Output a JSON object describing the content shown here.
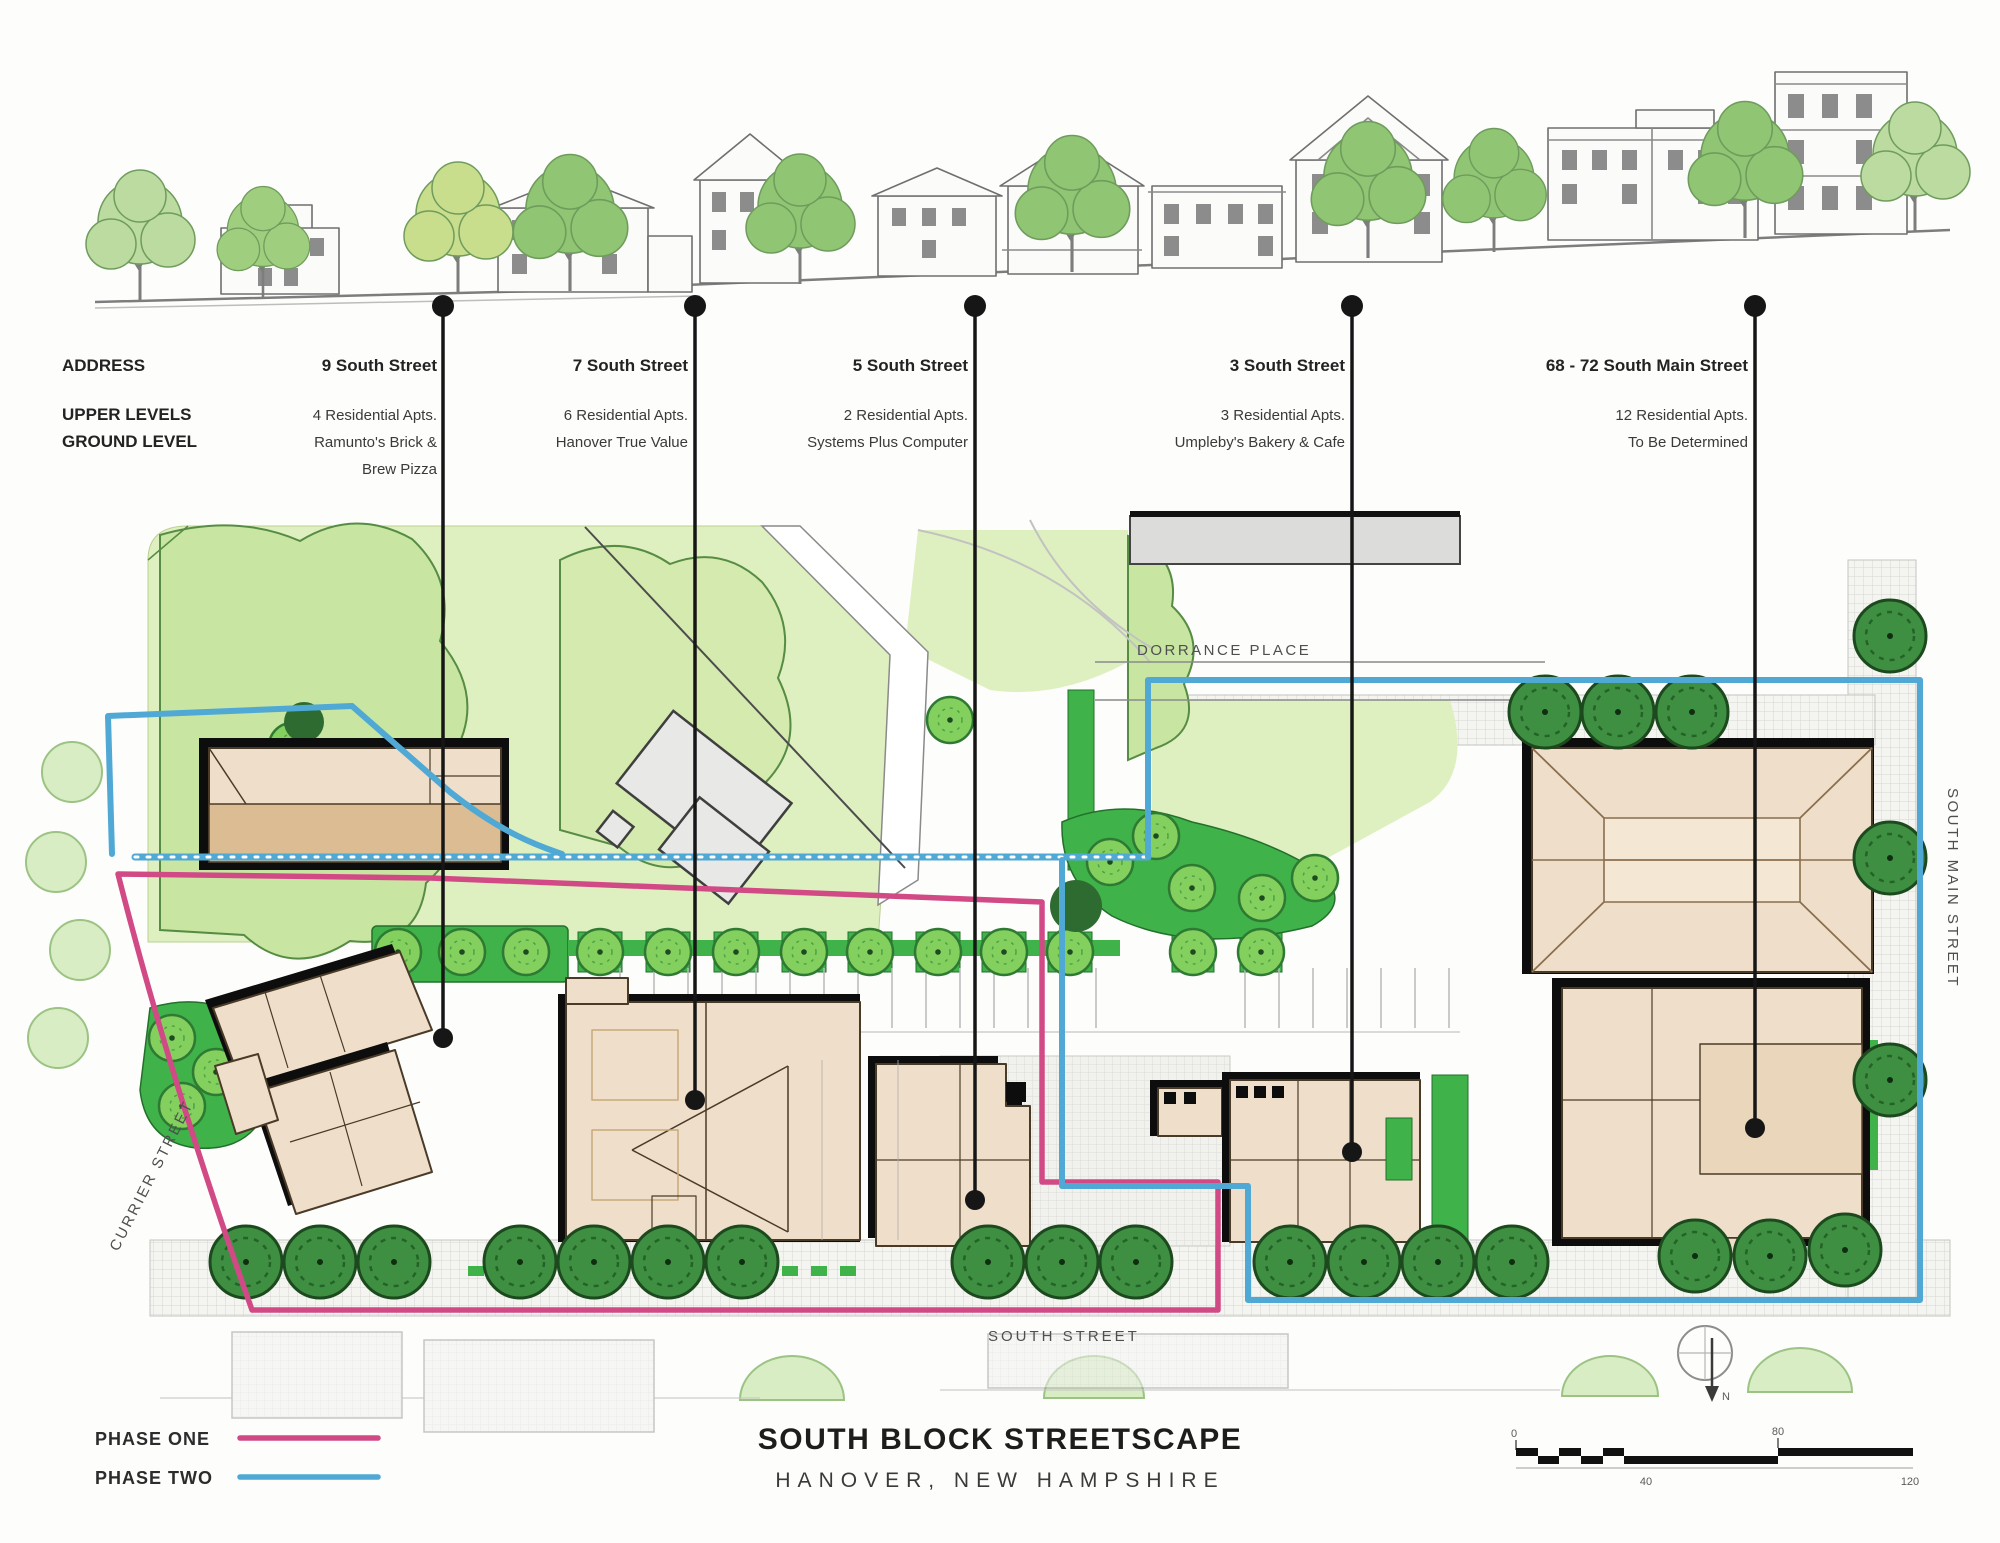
{
  "title": {
    "line1": "SOUTH BLOCK STREETSCAPE",
    "line2": "HANOVER, NEW HAMPSHIRE"
  },
  "row_labels": {
    "address": "ADDRESS",
    "upper": "UPPER LEVELS",
    "ground": "GROUND LEVEL"
  },
  "columns": [
    {
      "address": "9 South Street",
      "lines": [
        "4 Residential Apts.",
        "Ramunto's Brick &",
        "Brew Pizza"
      ]
    },
    {
      "address": "7 South Street",
      "lines": [
        "6 Residential Apts.",
        "Hanover True Value"
      ]
    },
    {
      "address": "5 South Street",
      "lines": [
        "2 Residential Apts.",
        "Systems Plus Computer"
      ]
    },
    {
      "address": "3 South Street",
      "lines": [
        "3 Residential Apts.",
        "Umpleby's Bakery & Cafe"
      ]
    },
    {
      "address": "68 - 72  South Main Street",
      "lines": [
        "12 Residential Apts.",
        "To Be Determined"
      ]
    }
  ],
  "streets": {
    "dorrance": "DORRANCE PLACE",
    "south_main": "SOUTH MAIN STREET",
    "currier": "CURRIER STREET",
    "south": "SOUTH STREET"
  },
  "legend": [
    {
      "label": "PHASE ONE",
      "color": "#D14A86"
    },
    {
      "label": "PHASE TWO",
      "color": "#4FA9D4"
    }
  ],
  "scale_bar": {
    "labels": [
      "0",
      "40",
      "80",
      "120"
    ]
  },
  "north_arrow_label": "N",
  "colors": {
    "lawn": "#DFF0C0",
    "canopy": "#C8E6A2",
    "bright_green": "#3FB24A",
    "street_tree": "#84D05F",
    "dark_tree": "#3F8F42",
    "building_tan": "#EFDFCA",
    "building_shade": "#DCBD93",
    "existing_gray": "#E8E8E6"
  }
}
